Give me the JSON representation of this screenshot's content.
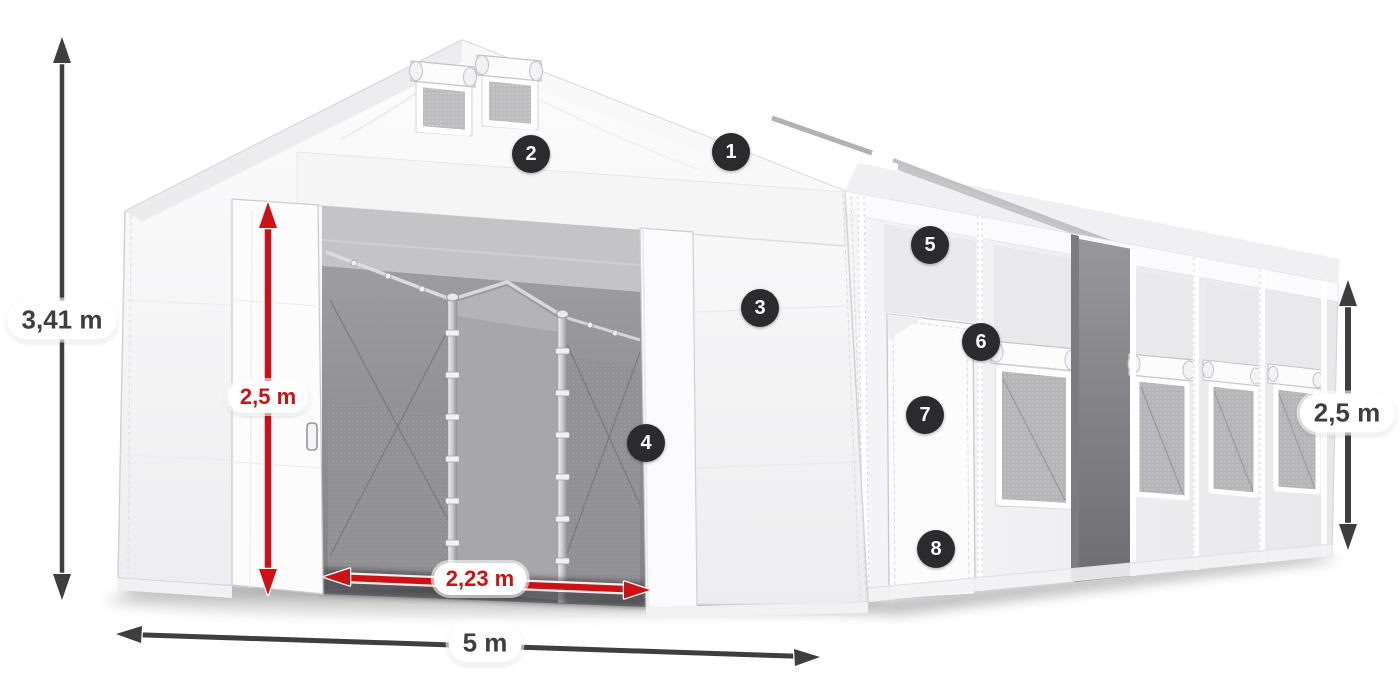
{
  "page": {
    "background": "#ffffff",
    "description": "3D diagram of a white storage tent with numbered feature markers and dimension arrows"
  },
  "measurements": {
    "total_height": "3,41 m",
    "entrance_height": "2,5 m",
    "entrance_width": "2,23 m",
    "tent_width": "5 m",
    "side_wall_height": "2,5 m"
  },
  "badges": [
    {
      "number": "1"
    },
    {
      "number": "2"
    },
    {
      "number": "3"
    },
    {
      "number": "4"
    },
    {
      "number": "5"
    },
    {
      "number": "6"
    },
    {
      "number": "7"
    },
    {
      "number": "8"
    }
  ],
  "colors": {
    "accent_red": "#cc1214",
    "dimension_gray": "#3e3e41",
    "badge_background": "#2b2b2d",
    "badge_text": "#ffffff",
    "tent_white": "#f7f7f8",
    "mesh_gray": "#b5b5b8"
  }
}
